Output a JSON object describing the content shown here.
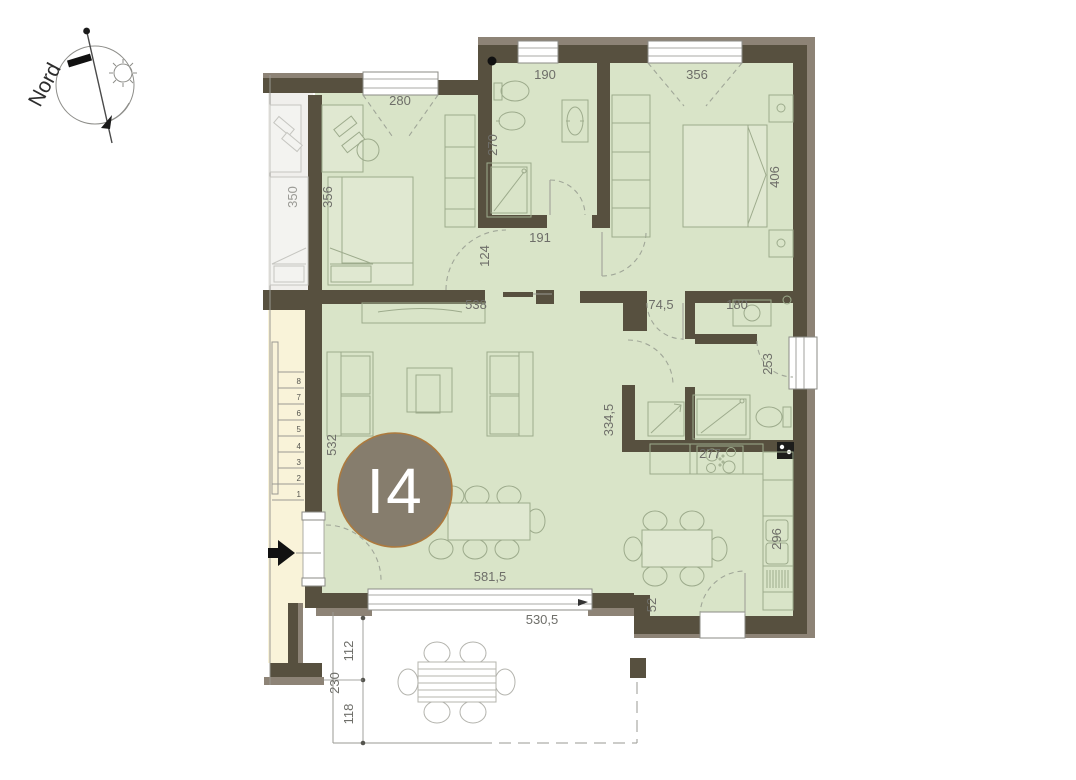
{
  "title": "Floor plan unit I4",
  "compass": {
    "label": "Nord"
  },
  "unit": {
    "label": "I4"
  },
  "colors": {
    "wall": "#57503f",
    "insulation_band": "#8d8376",
    "floor_green": "#d9e4c8",
    "stairwell_yellow": "#f9f3d9",
    "neighbor_gray": "#f0efec",
    "unit_badge_fill": "#867d6d",
    "unit_badge_border": "#ad7a3e",
    "dimension_text": "#6e6e69"
  },
  "dimensions": {
    "d280": "280",
    "d190": "190",
    "d356_win": "356",
    "d270": "270",
    "d350": "350",
    "d356_room": "356",
    "d406": "406",
    "d191": "191",
    "d124": "124",
    "d538": "538",
    "d74_5": "74,5",
    "d180": "180",
    "d253": "253",
    "d532": "532",
    "d334_5": "334,5",
    "d277": "277",
    "d296": "296",
    "d581_5": "581,5",
    "d52": "52",
    "d530_5": "530,5",
    "d112": "112",
    "d230": "230",
    "d118": "118"
  },
  "stairs": {
    "steps": [
      "1",
      "2",
      "3",
      "4",
      "5",
      "6",
      "7",
      "8"
    ]
  }
}
